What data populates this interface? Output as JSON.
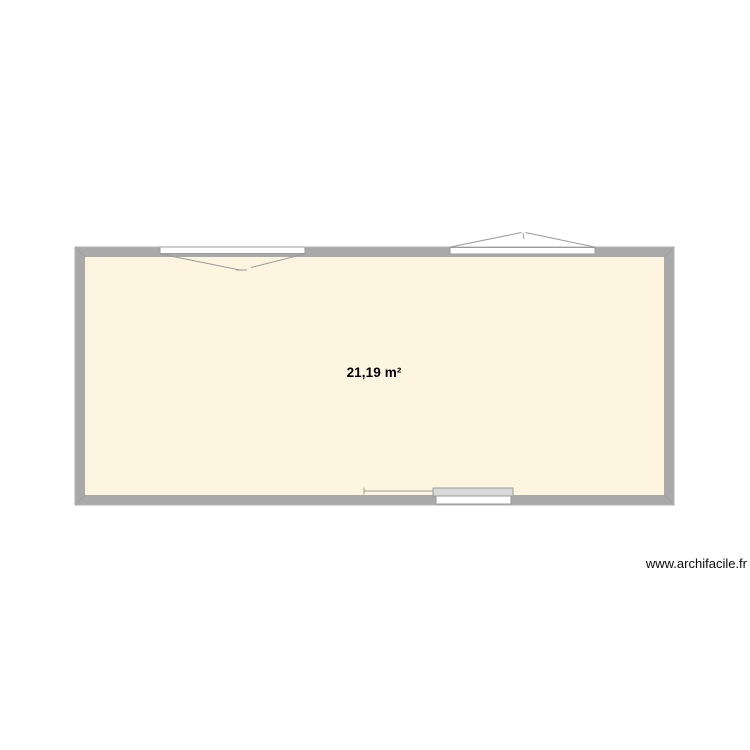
{
  "page": {
    "background": "#ffffff"
  },
  "watermark": {
    "text": "www.archifacile.fr"
  },
  "plan": {
    "room": {
      "area_label": "21,19 m²"
    },
    "colors": {
      "wall": "#a9a9a9",
      "wall_outline": "#b3b3b3",
      "miter": "#9b9b9b",
      "floor": "#fdf5e0",
      "symbol_stroke": "#9b9b9b",
      "window_frame_fill": "#ffffff",
      "sliding_panel_fill": "#d9d9d9"
    },
    "elements": [
      {
        "name": "window-top-left",
        "type": "window",
        "opening_direction": "inward"
      },
      {
        "name": "window-top-right",
        "type": "window",
        "opening_direction": "outward"
      },
      {
        "name": "sliding-window-bottom",
        "type": "sliding-window"
      }
    ]
  }
}
